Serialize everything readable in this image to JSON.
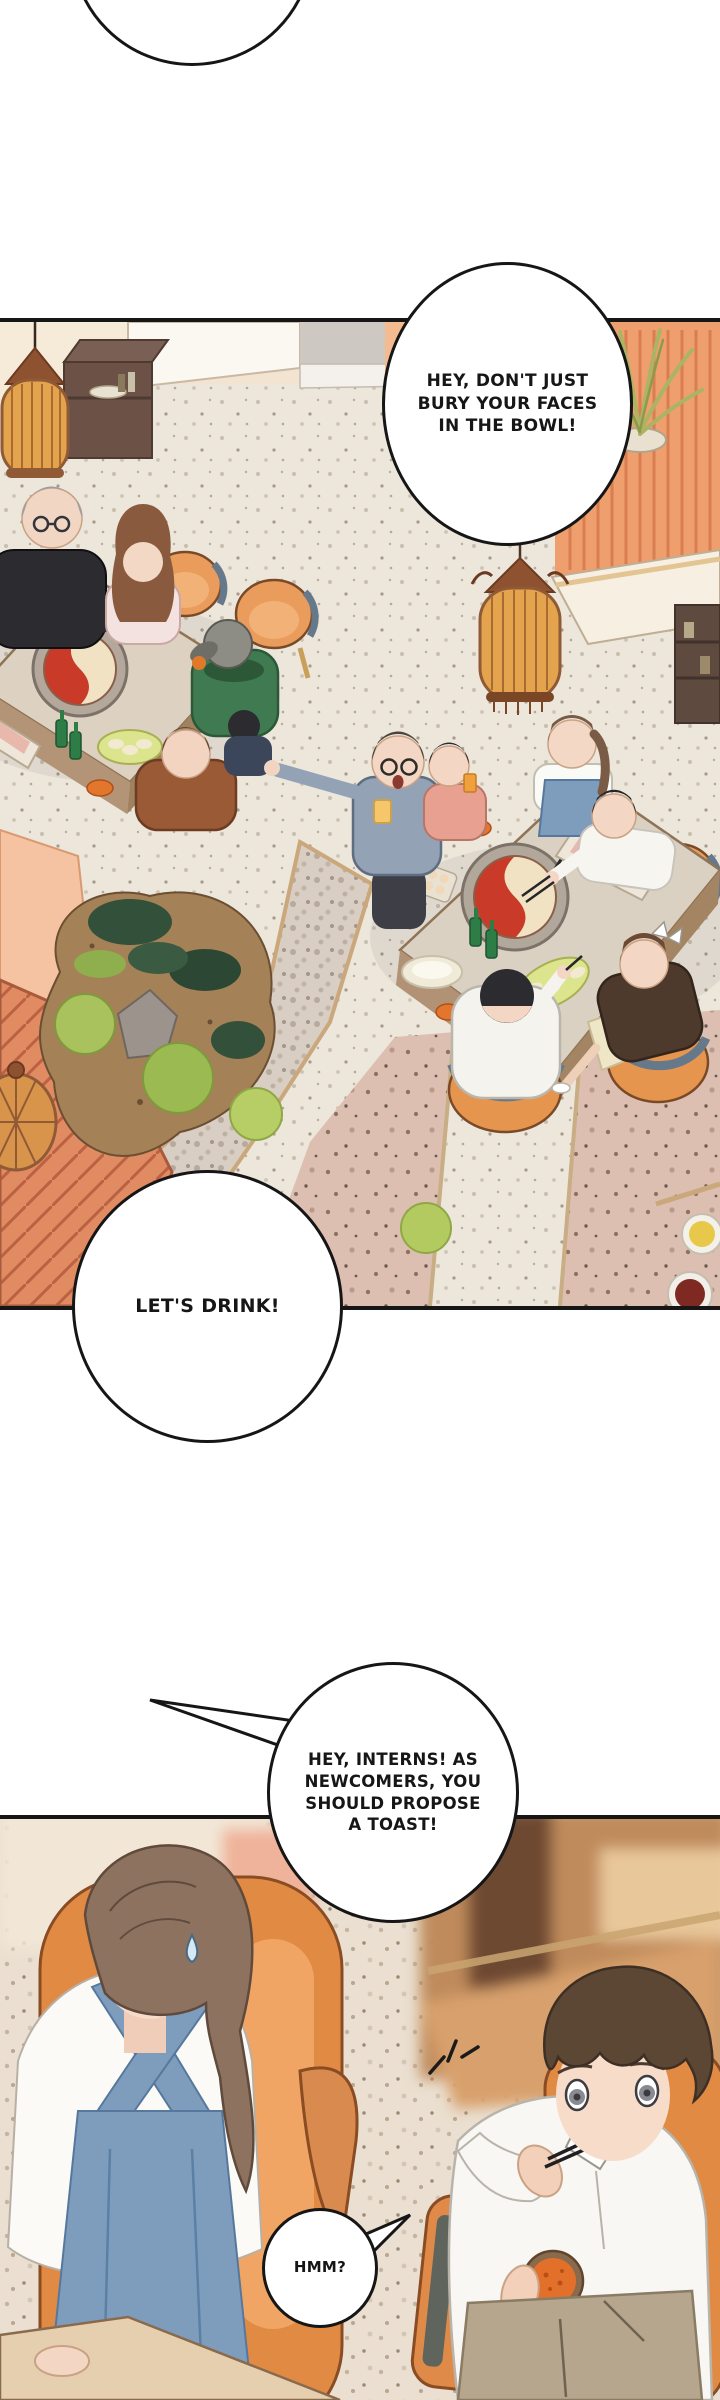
{
  "page": {
    "kind": "webtoon-comic-page",
    "background_color": "#ffffff",
    "ink_color": "#161616"
  },
  "speech_bubbles": {
    "boss_shout": {
      "text": "HEY, DON'T JUST\nBURY YOUR FACES\nIN THE BOWL!"
    },
    "lets_drink": {
      "text": "LET'S DRINK!"
    },
    "toast_demand": {
      "text": "HEY, INTERNS! AS\nNEWCOMERS, YOU\nSHOULD PROPOSE\nA TOAST!"
    },
    "hmm": {
      "text": "HMM?"
    }
  },
  "palette": {
    "paper": "#ffffff",
    "ink": "#161616",
    "floor_terrazzo": "#ece5da",
    "floor_mauve": "#d9bdaf",
    "wall_cream": "#f3e3d1",
    "wall_orange_partition": "#ef9f6e",
    "wall_salmon": "#f4bb90",
    "deck_terracotta": "#e18b63",
    "lantern_orange": "#e3a44d",
    "lantern_frame": "#8f5a35",
    "chair_orange": "#e6954f",
    "chair_back_slate": "#66798b",
    "table_top": "#dbd1c3",
    "hotpot_red_broth": "#c93a28",
    "hotpot_white_broth": "#f0e2c2",
    "apron_blue": "#7e9dbd",
    "hoodie_green": "#3f7a50",
    "moss_green": "#a9c25e",
    "bush_dark": "#32503a",
    "sauce_orange": "#e2702a"
  }
}
